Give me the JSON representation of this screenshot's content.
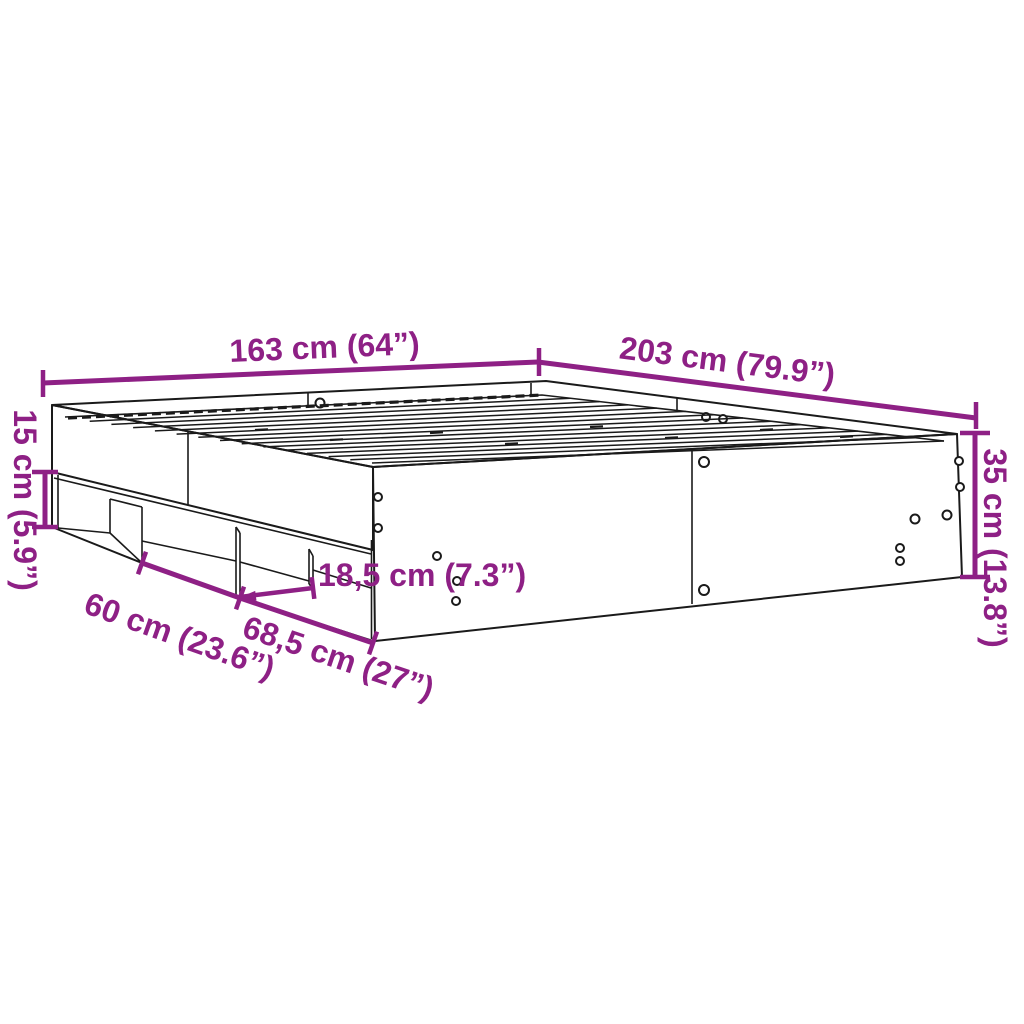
{
  "diagram": {
    "title": "bed-frame-dimension-diagram",
    "dimensions": {
      "head_width": "163 cm (64”)",
      "length": "203 cm (79.9”)",
      "plinth_height": "15 cm (5.9”)",
      "frame_height": "35 cm (13.8”)",
      "niche_depth": "18,5 cm (7.3”)",
      "niche_width_left": "60 cm (23.6”)",
      "niche_width_front": "68,5 cm (27”)"
    },
    "colors": {
      "dimension": "#8E2085",
      "line_art": "#1A1A1A",
      "background": "#FFFFFF"
    }
  }
}
